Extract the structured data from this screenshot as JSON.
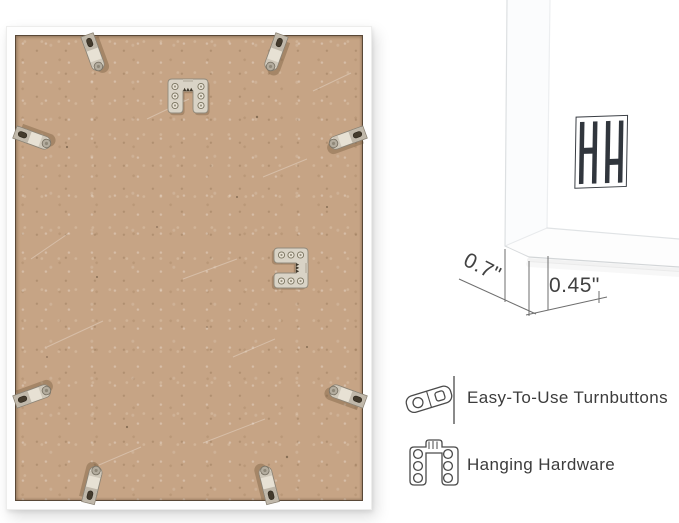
{
  "product": {
    "type": "picture-frame-back-view",
    "frame_color": "#ffffff",
    "backing_color": "#c6a485"
  },
  "dimensions": {
    "depth_label": "0.7\"",
    "face_label": "0.45\""
  },
  "features": [
    {
      "icon": "turnbutton-icon",
      "label": "Easy-To-Use Turnbuttons"
    },
    {
      "icon": "hanging-hardware-icon",
      "label": "Hanging Hardware"
    }
  ],
  "hardware": {
    "turnbutton_count": 8,
    "hanger_count": 2,
    "metal_color": "#d9d3c6"
  },
  "brand": {
    "logo_icon": "hh-bars-logo",
    "logo_color": "#31363d"
  },
  "annotation": {
    "line_color": "#6e6e6e",
    "text_color": "#414141"
  }
}
